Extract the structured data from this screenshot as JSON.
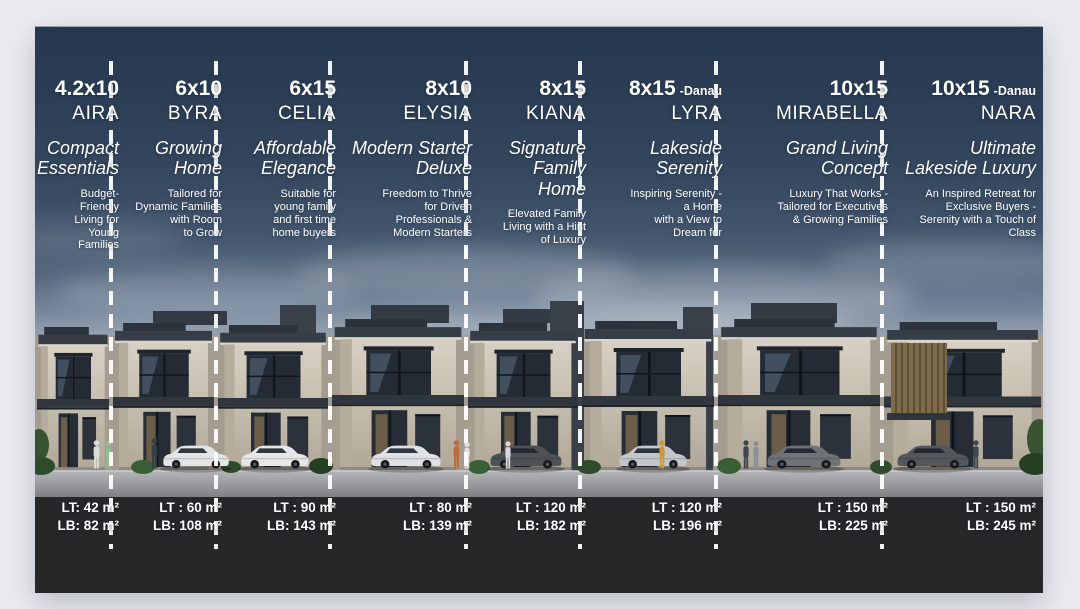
{
  "page": {
    "background": "#eaebf0"
  },
  "card": {
    "colors": {
      "sky_top": "#26384f",
      "sky_horizon": "#b7bec7",
      "spec_band": "#272729",
      "divider": "#ffffff",
      "text": "#ffffff",
      "house_facade": "#cfc7b8",
      "house_roof": "#363d46"
    },
    "units": [
      {
        "size": "4.2x10",
        "suffix": "",
        "name": "AIRA",
        "tagline": "Compact\nEssentials",
        "description": "Budget-\nFriendly\nLiving for\nYoung\nFamilies",
        "lt": "LT: 42 m²",
        "lb": "LB: 82 m²"
      },
      {
        "size": "6x10",
        "suffix": "",
        "name": "BYRA",
        "tagline": "Growing\nHome",
        "description": "Tailored for\nDynamic Families\nwith Room\nto Grow",
        "lt": "LT : 60 m²",
        "lb": "LB: 108 m²"
      },
      {
        "size": "6x15",
        "suffix": "",
        "name": "CELIA",
        "tagline": "Affordable\nElegance",
        "description": "Suitable for\nyoung family\nand first time\nhome buyers",
        "lt": "LT : 90 m²",
        "lb": "LB: 143 m²"
      },
      {
        "size": "8x10",
        "suffix": "",
        "name": "ELYSIA",
        "tagline": "Modern Starter\nDeluxe",
        "description": "Freedom to Thrive\nfor Driven\nProfessionals &\nModern Starters",
        "lt": "LT : 80 m²",
        "lb": "LB: 139 m²"
      },
      {
        "size": "8x15",
        "suffix": "",
        "name": "KIANA",
        "tagline": "Signature\nFamily Home",
        "description": "Elevated Family\nLiving with a Hint\nof Luxury",
        "lt": "LT : 120 m²",
        "lb": "LB: 182 m²"
      },
      {
        "size": "8x15",
        "suffix": "-Danau",
        "name": "LYRA",
        "tagline": "Lakeside\nSerenity",
        "description": "Inspiring Serenity -\na Home\nwith a View to\nDream for",
        "lt": "LT : 120 m²",
        "lb": "LB: 196 m²"
      },
      {
        "size": "10x15",
        "suffix": "",
        "name": "MIRABELLA",
        "tagline": "Grand Living\nConcept",
        "description": "Luxury That Works -\nTailored for Executives\n& Growing Families",
        "lt": "LT : 150 m²",
        "lb": "LB: 225 m²"
      },
      {
        "size": "10x15",
        "suffix": "-Danau",
        "name": "NARA",
        "tagline": "Ultimate\nLakeside Luxury",
        "description": "An Inspired Retreat for\nExclusive Buyers -\nSerenity with a Touch of\nClass",
        "lt": "LT : 150 m²",
        "lb": "LB: 245 m²"
      }
    ]
  }
}
